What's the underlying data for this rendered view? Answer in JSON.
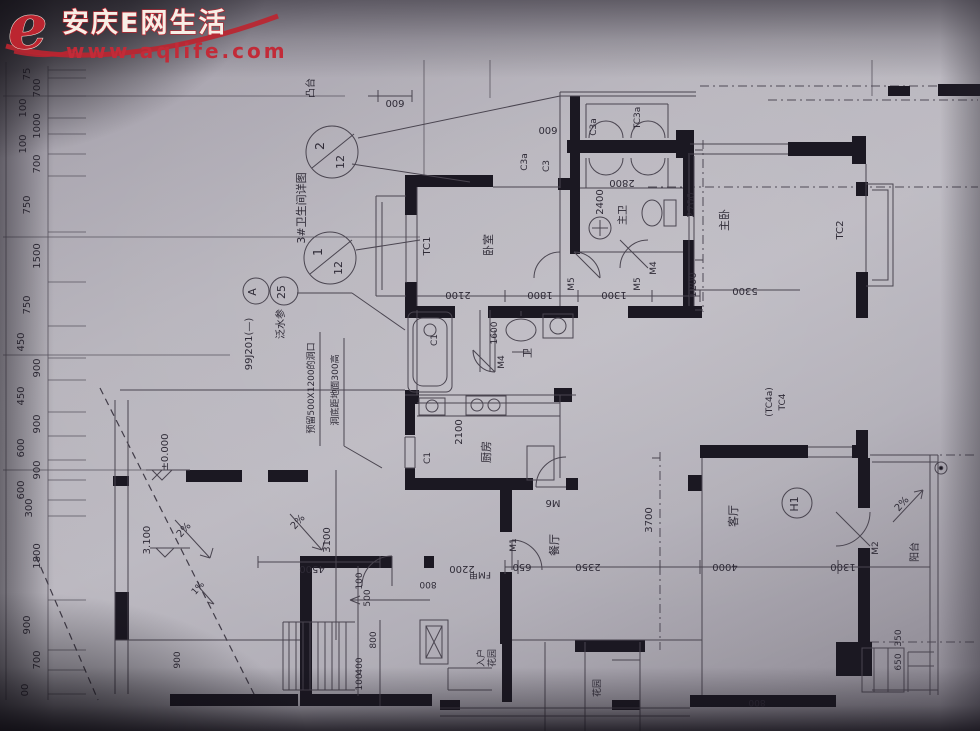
{
  "watermark": {
    "brand": "安庆E网生活",
    "url": "www.aqlife.com",
    "accent": "#bc2530"
  },
  "bubbles": {
    "b2_top": "2",
    "b2_bot": "12",
    "b1_top": "1",
    "b1_bot": "12",
    "a_top": "A",
    "a_bot": "25",
    "h1": "H1"
  },
  "notes": {
    "terrace": "凸台",
    "bath_detail": "3#卫生间详图",
    "flashing": "泛水参",
    "atlas": "99J201(—)",
    "hole_line1": "预留500X1200的洞口",
    "hole_line2": "洞底距地面300高"
  },
  "levels": {
    "upper": "3.100",
    "zero": "±0.000"
  },
  "slopes": {
    "two": "2%",
    "one": "1%"
  },
  "rooms": {
    "master_bed": "主卧",
    "master_bath": "主卫",
    "bedroom": "卧室",
    "bath": "卫",
    "kitchen": "厨房",
    "dining": "餐厅",
    "living": "客厅",
    "balcony": "阳台",
    "entry1": "入户",
    "entry2": "花园"
  },
  "marks": {
    "tc1": "TC1",
    "tc2": "TC2",
    "tc3a": "TC3a",
    "tc4": "TC4",
    "tc4a": "(TC4a)",
    "c1": "C1",
    "c3": "C3",
    "c3a": "C3a",
    "m1": "M1",
    "m2": "M2",
    "m4": "M4",
    "m5": "M5",
    "m6": "M6",
    "fmj": "FM甲"
  },
  "left_dims": [
    "75",
    "700",
    "100",
    "1000",
    "100",
    "700",
    "750",
    "1500",
    "750",
    "450",
    "900",
    "450",
    "900",
    "600",
    "900",
    "600",
    "300",
    "1800",
    "900",
    "700",
    "00"
  ],
  "dims": {
    "d2100": "2100",
    "d1800": "1800",
    "d1300": "1300",
    "d2400": "2400",
    "d2800": "2800",
    "d600": "600",
    "d2700": "2700",
    "d1200": "1200",
    "d5300": "5300",
    "d1600": "1600",
    "d3700": "3700",
    "d4000": "4000",
    "d2350": "2350",
    "d650": "650",
    "d2200": "2200",
    "d800": "800",
    "d400": "400",
    "d100": "100",
    "d500": "500",
    "d3100": "3100",
    "d4500": "4500",
    "d350": "350",
    "d900": "900"
  }
}
